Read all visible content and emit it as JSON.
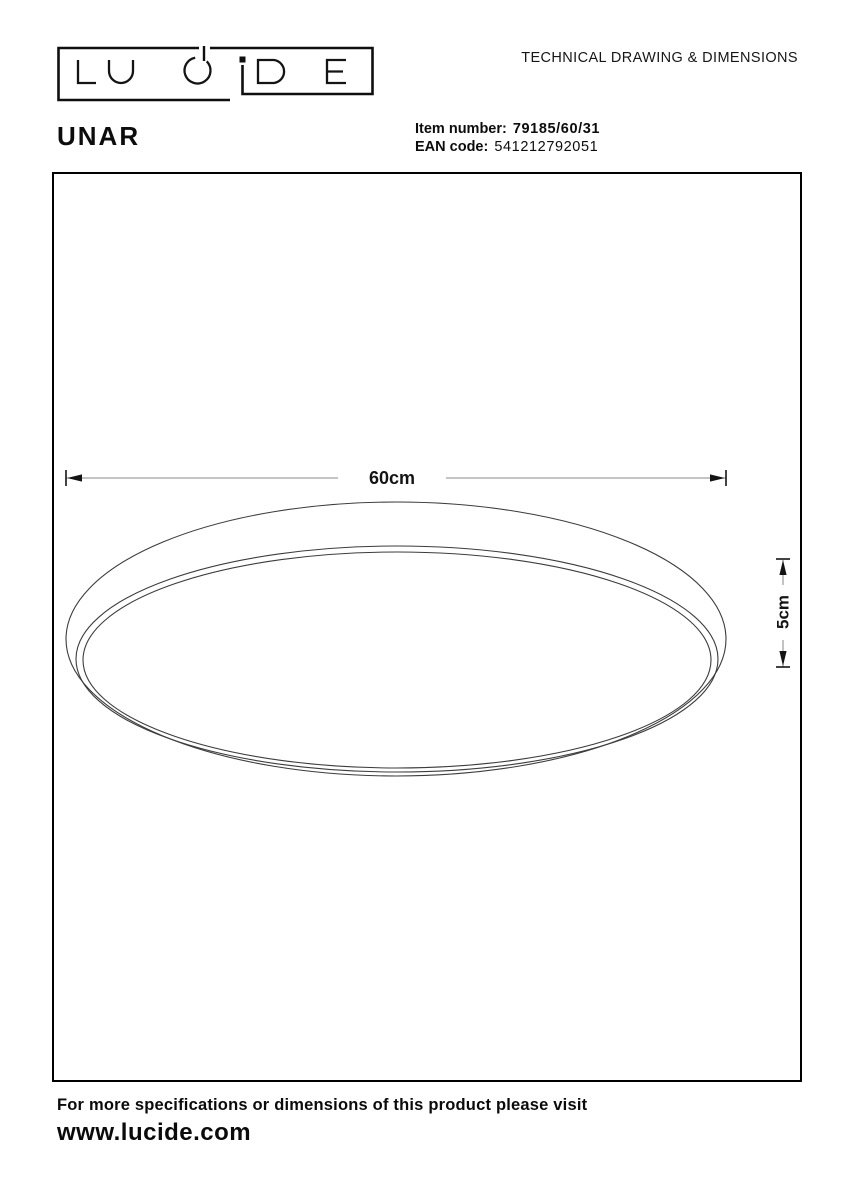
{
  "brand": {
    "logo_text": "LUCIDE"
  },
  "header": {
    "doc_title": "TECHNICAL DRAWING & DIMENSIONS"
  },
  "product": {
    "name": "UNAR",
    "item_number_label": "Item number:",
    "item_number": "79185/60/31",
    "ean_label": "EAN code:",
    "ean_code": "541212792051"
  },
  "drawing": {
    "width_label": "60cm",
    "height_label": "5cm"
  },
  "footer": {
    "note": "For more specifications or dimensions of this product please visit",
    "website": "www.lucide.com"
  },
  "colors": {
    "ink": "#111111",
    "dim_line_gray": "#8a8a8a",
    "drawing_stroke": "#3c3c3c",
    "border_black": "#000000"
  }
}
